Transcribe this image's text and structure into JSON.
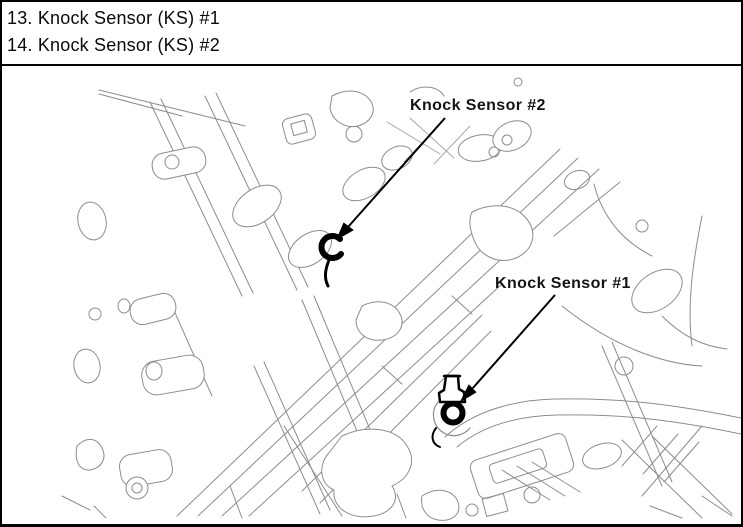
{
  "figure": {
    "background": "#ffffff",
    "border_color": "#000000",
    "line_art_color": "#8c8c8c",
    "ink_color": "#000000"
  },
  "legend": {
    "items": [
      {
        "text": "13. Knock Sensor (KS) #1"
      },
      {
        "text": "14. Knock Sensor (KS) #2"
      }
    ]
  },
  "diagram": {
    "subject": "engine-cylinder-block-line-drawing",
    "callouts": [
      {
        "label": "Knock Sensor #2"
      },
      {
        "label": "Knock Sensor #1"
      }
    ]
  }
}
